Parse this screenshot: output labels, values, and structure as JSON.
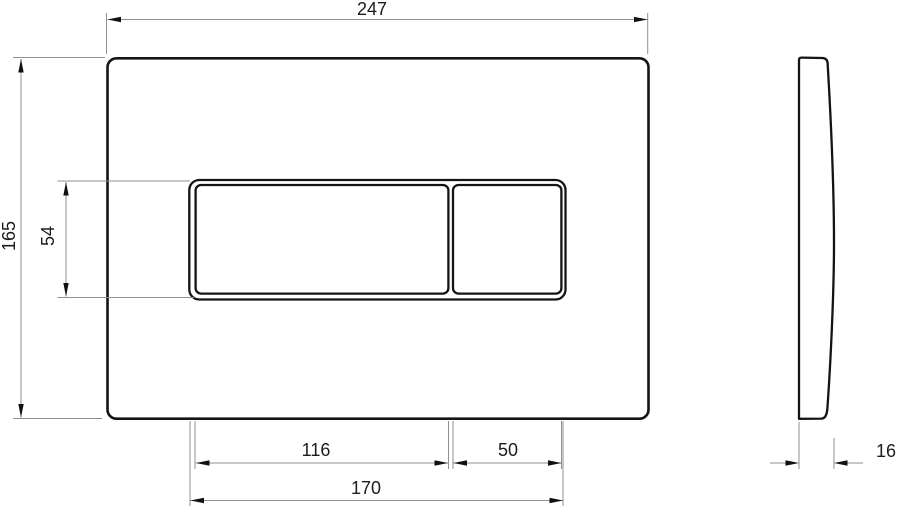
{
  "watermark": {
    "text": "rent.sk"
  },
  "views": {
    "front": "front-view",
    "side": "side-view"
  },
  "dimensions": {
    "plate_width": "247",
    "plate_height": "165",
    "button_recess_height": "54",
    "large_button_width": "116",
    "small_button_width": "50",
    "recess_width": "170",
    "plate_thickness": "16"
  },
  "colors": {
    "outline": "#141414",
    "dim_lines": "#8f8f8f",
    "text": "#1c1c1c",
    "watermark": "#e3d8d8",
    "background": "#ffffff"
  }
}
